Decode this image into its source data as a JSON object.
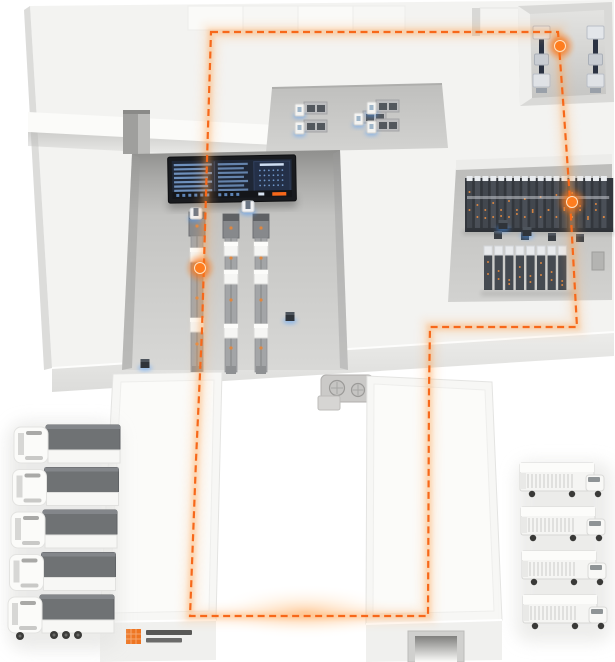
{
  "illustration": {
    "type": "isometric-smart-warehouse",
    "palette": {
      "accent_orange": "#f7681a",
      "glow_orange": "#ff9a3e",
      "node_orange": "#ff7d1f",
      "agv_blue": "#4a9bff",
      "slab": "#f3f3f1",
      "recess_gray": "#c8c8c6",
      "rack_dark": "#41464d",
      "truck_cargo_gray": "#6f7274",
      "screen_bg": "#1f2736",
      "screen_blue": "#7ca3d4"
    },
    "flow_route": {
      "points": [
        [
          211,
          32
        ],
        [
          558,
          32
        ],
        [
          563,
          100
        ],
        [
          570,
          200
        ],
        [
          577,
          327
        ],
        [
          430,
          327
        ],
        [
          429,
          390
        ],
        [
          428,
          616
        ],
        [
          190,
          616
        ],
        [
          196,
          460
        ],
        [
          202,
          330
        ],
        [
          207,
          160
        ]
      ],
      "closed": true,
      "dash": [
        7,
        4.5
      ],
      "nodes": [
        {
          "x": 560,
          "y": 46
        },
        {
          "x": 572,
          "y": 202
        },
        {
          "x": 200,
          "y": 268
        }
      ]
    },
    "equipment": {
      "inbound_machines": {
        "xs": [
          533,
          587
        ],
        "y": 26
      },
      "workstations": [
        {
          "x": 295,
          "y": 102
        },
        {
          "x": 295,
          "y": 120
        },
        {
          "x": 354,
          "y": 111
        },
        {
          "x": 367,
          "y": 100
        },
        {
          "x": 367,
          "y": 119
        }
      ],
      "conveyor_lines": {
        "bottom": 372,
        "lines": [
          {
            "x": 197,
            "head_y": 212,
            "boxes": [
              248,
              318
            ],
            "dots": [
              272,
              298,
              344
            ]
          },
          {
            "x": 231,
            "head_y": 214,
            "boxes": [
              242,
              270,
              324
            ],
            "dots": [
              258,
              300,
              348
            ]
          },
          {
            "x": 261,
            "head_y": 214,
            "boxes": [
              242,
              270,
              324
            ],
            "dots": [
              258,
              300,
              348
            ]
          }
        ]
      },
      "rack_long_row": {
        "x": 467,
        "y": 180,
        "count": 18,
        "step": 7.9,
        "height": 48
      },
      "rack_block": {
        "x": 484,
        "y": 246,
        "count": 8,
        "step": 10.6,
        "height": 44
      },
      "pallet_boxes": [
        {
          "x": 494,
          "y": 231
        },
        {
          "x": 521,
          "y": 232
        },
        {
          "x": 548,
          "y": 233
        },
        {
          "x": 576,
          "y": 234
        }
      ],
      "agvs": [
        {
          "x": 248,
          "y": 206,
          "kind": "carrier"
        },
        {
          "x": 196,
          "y": 213,
          "kind": "carrier"
        },
        {
          "x": 290,
          "y": 316,
          "kind": "shuttle"
        },
        {
          "x": 145,
          "y": 363,
          "kind": "shuttle"
        },
        {
          "x": 503,
          "y": 224,
          "kind": "shuttle"
        },
        {
          "x": 527,
          "y": 231,
          "kind": "shuttle"
        }
      ]
    },
    "fleet": {
      "heavy_trucks": {
        "count": 5,
        "x": 12,
        "y": 423,
        "step": 42.5,
        "dx": -1.5
      },
      "delivery_vans": {
        "count": 4,
        "x": 514,
        "y": 461,
        "step": 44,
        "dx": 1
      }
    },
    "screen": {
      "x": 168,
      "y": 156,
      "w": 128,
      "h": 46,
      "left_rows": 7,
      "mid_rows": 7,
      "dot_cols": 6,
      "dot_rows": 4
    },
    "logo": {
      "x": 126,
      "y": 629,
      "mark_color": "#ee7420",
      "text_lines": 2
    }
  }
}
